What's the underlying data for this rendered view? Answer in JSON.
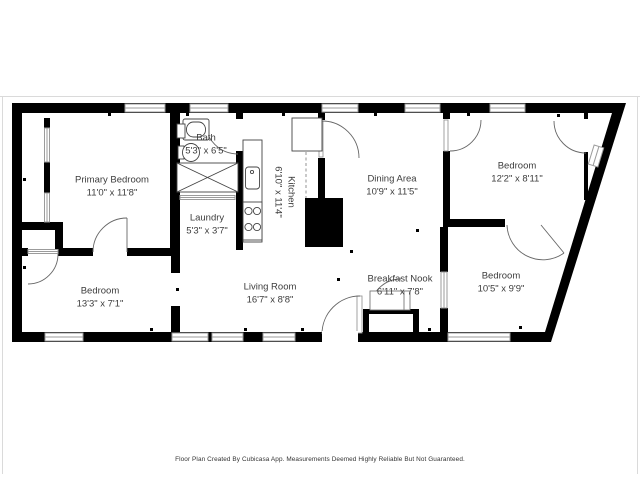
{
  "image_type": "floor-plan",
  "footer_note": "Floor Plan Created By Cubicasa App. Measurements Deemed Highly Reliable But Not Guaranteed.",
  "rooms": [
    {
      "name": "Primary Bedroom",
      "dims": "11'0\" x 11'8\""
    },
    {
      "name": "Bath",
      "dims": "5'3\" x 6'5\""
    },
    {
      "name": "Laundry",
      "dims": "5'3\" x 3'7\""
    },
    {
      "name": "Kitchen",
      "dims": "6'10\" x 11'4\"",
      "label_rotated_90": true
    },
    {
      "name": "Dining Area",
      "dims": "10'9\" x 11'5\""
    },
    {
      "name": "Bedroom",
      "dims": "12'2\" x 8'11\""
    },
    {
      "name": "Bedroom",
      "dims": "13'3\" x 7'1\""
    },
    {
      "name": "Living Room",
      "dims": "16'7\" x 8'8\""
    },
    {
      "name": "Breakfast Nook",
      "dims": "6'11\" x 7'8\""
    },
    {
      "name": "Bedroom",
      "dims": "10'5\" x 9'9\""
    }
  ],
  "fixtures": [
    "bathtub",
    "toilet",
    "bathroom-sink",
    "washer-dryer-closet",
    "kitchen-counter",
    "kitchen-sink",
    "stove",
    "refrigerator",
    "fireplace",
    "entry-porch"
  ],
  "colors": {
    "wall": "#000000",
    "window": "#9b9b9b",
    "door_arc": "#666666",
    "text": "#3c3c3c",
    "background": "#ffffff",
    "frame_line": "#d9d9d9"
  }
}
